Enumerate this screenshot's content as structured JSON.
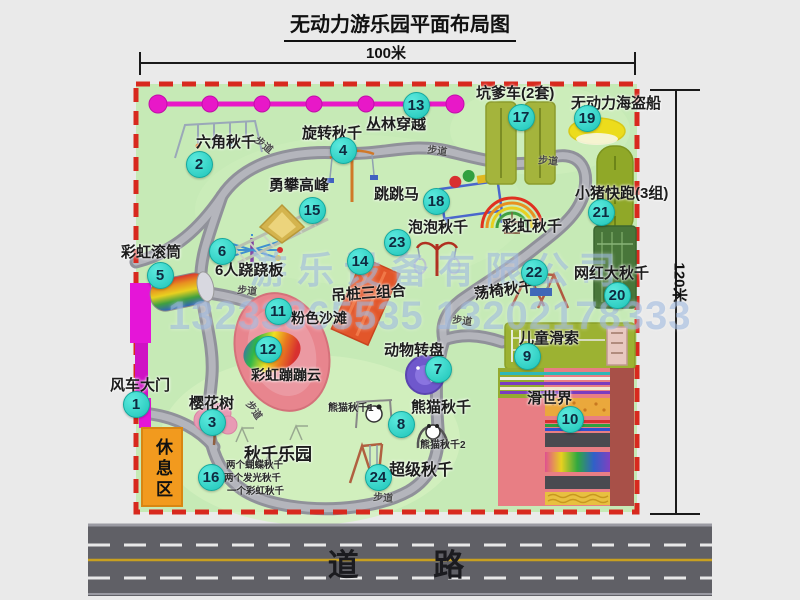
{
  "title": "无动力游乐园平面布局图",
  "dimensions": {
    "top": "100米",
    "right": "120米"
  },
  "road_label": "道    路",
  "rest_area_label": "休息区",
  "watermark": {
    "company": "游乐设备有限公司",
    "phone": "13233865535 13202178333"
  },
  "attractions": [
    {
      "num": "1",
      "label": "风车大门",
      "lx": 110,
      "ly": 378,
      "ls": 15,
      "lr": 0,
      "bx": 136,
      "by": 404
    },
    {
      "num": "2",
      "label": "六角秋千",
      "lx": 196,
      "ly": 135,
      "ls": 15,
      "lr": 0,
      "bx": 199,
      "by": 164
    },
    {
      "num": "3",
      "label": "樱花树",
      "lx": 189,
      "ly": 396,
      "ls": 15,
      "lr": 0,
      "bx": 212,
      "by": 422
    },
    {
      "num": "4",
      "label": "旋转秋千",
      "lx": 302,
      "ly": 126,
      "ls": 15,
      "lr": 0,
      "bx": 343,
      "by": 150
    },
    {
      "num": "5",
      "label": "彩虹滚筒",
      "lx": 121,
      "ly": 245,
      "ls": 15,
      "lr": 0,
      "bx": 160,
      "by": 275
    },
    {
      "num": "6",
      "label": "6人跷跷板",
      "lx": 215,
      "ly": 263,
      "ls": 15,
      "lr": 0,
      "bx": 222,
      "by": 251
    },
    {
      "num": "7",
      "label": "动物转盘",
      "lx": 384,
      "ly": 343,
      "ls": 15,
      "lr": 0,
      "bx": 438,
      "by": 369
    },
    {
      "num": "8",
      "label": "熊猫秋千",
      "lx": 411,
      "ly": 400,
      "ls": 15,
      "lr": 0,
      "bx": 401,
      "by": 424
    },
    {
      "num": "9",
      "label": "儿童滑索",
      "lx": 519,
      "ly": 331,
      "ls": 15,
      "lr": 0,
      "bx": 527,
      "by": 356
    },
    {
      "num": "10",
      "label": "滑世界",
      "lx": 527,
      "ly": 391,
      "ls": 15,
      "lr": 0,
      "bx": 570,
      "by": 419
    },
    {
      "num": "11",
      "label": "粉色沙滩",
      "lx": 291,
      "ly": 311,
      "ls": 14,
      "lr": 0,
      "bx": 278,
      "by": 311
    },
    {
      "num": "12",
      "label": "彩虹蹦蹦云",
      "lx": 251,
      "ly": 368,
      "ls": 14,
      "lr": 0,
      "bx": 268,
      "by": 349
    },
    {
      "num": "13",
      "label": "丛林穿越",
      "lx": 366,
      "ly": 117,
      "ls": 15,
      "lr": 0,
      "bx": 416,
      "by": 105
    },
    {
      "num": "14",
      "label": "吊桩三组合",
      "lx": 331,
      "ly": 286,
      "ls": 15,
      "lr": -4,
      "bx": 360,
      "by": 261
    },
    {
      "num": "15",
      "label": "勇攀高峰",
      "lx": 269,
      "ly": 178,
      "ls": 15,
      "lr": 0,
      "bx": 312,
      "by": 210
    },
    {
      "num": "16",
      "label": "秋千乐园",
      "lx": 244,
      "ly": 446,
      "ls": 17,
      "lr": 0,
      "bx": 211,
      "by": 477
    },
    {
      "num": "17",
      "label": "坑爹车(2套)",
      "lx": 476,
      "ly": 86,
      "ls": 15,
      "lr": 0,
      "bx": 521,
      "by": 117
    },
    {
      "num": "18",
      "label": "跳跳马",
      "lx": 374,
      "ly": 187,
      "ls": 15,
      "lr": 0,
      "bx": 436,
      "by": 201
    },
    {
      "num": "19",
      "label": "无动力海盗船",
      "lx": 571,
      "ly": 96,
      "ls": 15,
      "lr": 0,
      "bx": 587,
      "by": 118
    },
    {
      "num": "20",
      "label": "网红大秋千",
      "lx": 574,
      "ly": 266,
      "ls": 15,
      "lr": 0,
      "bx": 617,
      "by": 295
    },
    {
      "num": "21",
      "label": "小猪快跑(3组)",
      "lx": 575,
      "ly": 186,
      "ls": 15,
      "lr": 0,
      "bx": 601,
      "by": 212
    },
    {
      "num": "22",
      "label": "荡椅秋千",
      "lx": 474,
      "ly": 283,
      "ls": 15,
      "lr": -8,
      "bx": 534,
      "by": 272
    },
    {
      "num": "23",
      "label": "泡泡秋千",
      "lx": 408,
      "ly": 220,
      "ls": 15,
      "lr": 0,
      "bx": 397,
      "by": 242
    },
    {
      "num": "24",
      "label": "超级秋千",
      "lx": 389,
      "ly": 463,
      "ls": 16,
      "lr": 0,
      "bx": 378,
      "by": 477
    },
    {
      "num": "",
      "label": "彩虹秋千",
      "lx": 502,
      "ly": 219,
      "ls": 15,
      "lr": 0,
      "bx": 0,
      "by": 0
    }
  ],
  "sub_labels": [
    {
      "text": "熊猫秋千1",
      "x": 328,
      "y": 404,
      "size": 10
    },
    {
      "text": "熊猫秋千2",
      "x": 420,
      "y": 441,
      "size": 10
    },
    {
      "text": "两个蝴蝶秋千",
      "x": 226,
      "y": 461,
      "size": 9.5
    },
    {
      "text": "两个发光秋千",
      "x": 224,
      "y": 474,
      "size": 9.5
    },
    {
      "text": "一个彩虹秋千",
      "x": 227,
      "y": 487,
      "size": 9.5
    }
  ],
  "path_labels": [
    {
      "text": "步道",
      "x": 253,
      "y": 141,
      "rot": 38
    },
    {
      "text": "步道",
      "x": 427,
      "y": 147,
      "rot": 8
    },
    {
      "text": "步道",
      "x": 538,
      "y": 157,
      "rot": 4
    },
    {
      "text": "步道",
      "x": 237,
      "y": 287,
      "rot": 6
    },
    {
      "text": "步道",
      "x": 452,
      "y": 317,
      "rot": 8
    },
    {
      "text": "步道",
      "x": 243,
      "y": 406,
      "rot": 55
    },
    {
      "text": "步道",
      "x": 373,
      "y": 494,
      "rot": 5
    }
  ]
}
